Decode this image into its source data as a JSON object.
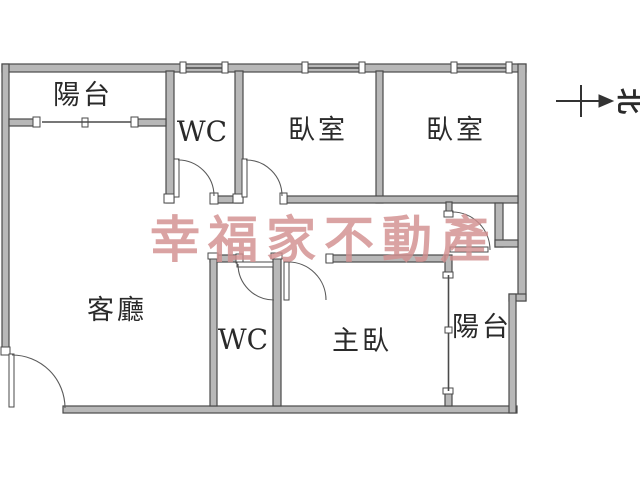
{
  "floor_plan": {
    "rooms": [
      {
        "id": "balcony-top",
        "label": "陽台"
      },
      {
        "id": "wc-top",
        "label": "WC"
      },
      {
        "id": "bedroom-1",
        "label": "臥室"
      },
      {
        "id": "bedroom-2",
        "label": "臥室"
      },
      {
        "id": "living-room",
        "label": "客廳"
      },
      {
        "id": "wc-bottom",
        "label": "WC"
      },
      {
        "id": "master-bedroom",
        "label": "主臥"
      },
      {
        "id": "balcony-right",
        "label": "陽台"
      }
    ],
    "watermark": {
      "text": "幸福家不動產",
      "color": "#d29090"
    },
    "compass": {
      "label": "北"
    },
    "colors": {
      "wall_fill": "#b8b8b8",
      "wall_stroke": "#4a4a4a",
      "label_color": "#2a2a2a",
      "background": "#ffffff"
    }
  }
}
